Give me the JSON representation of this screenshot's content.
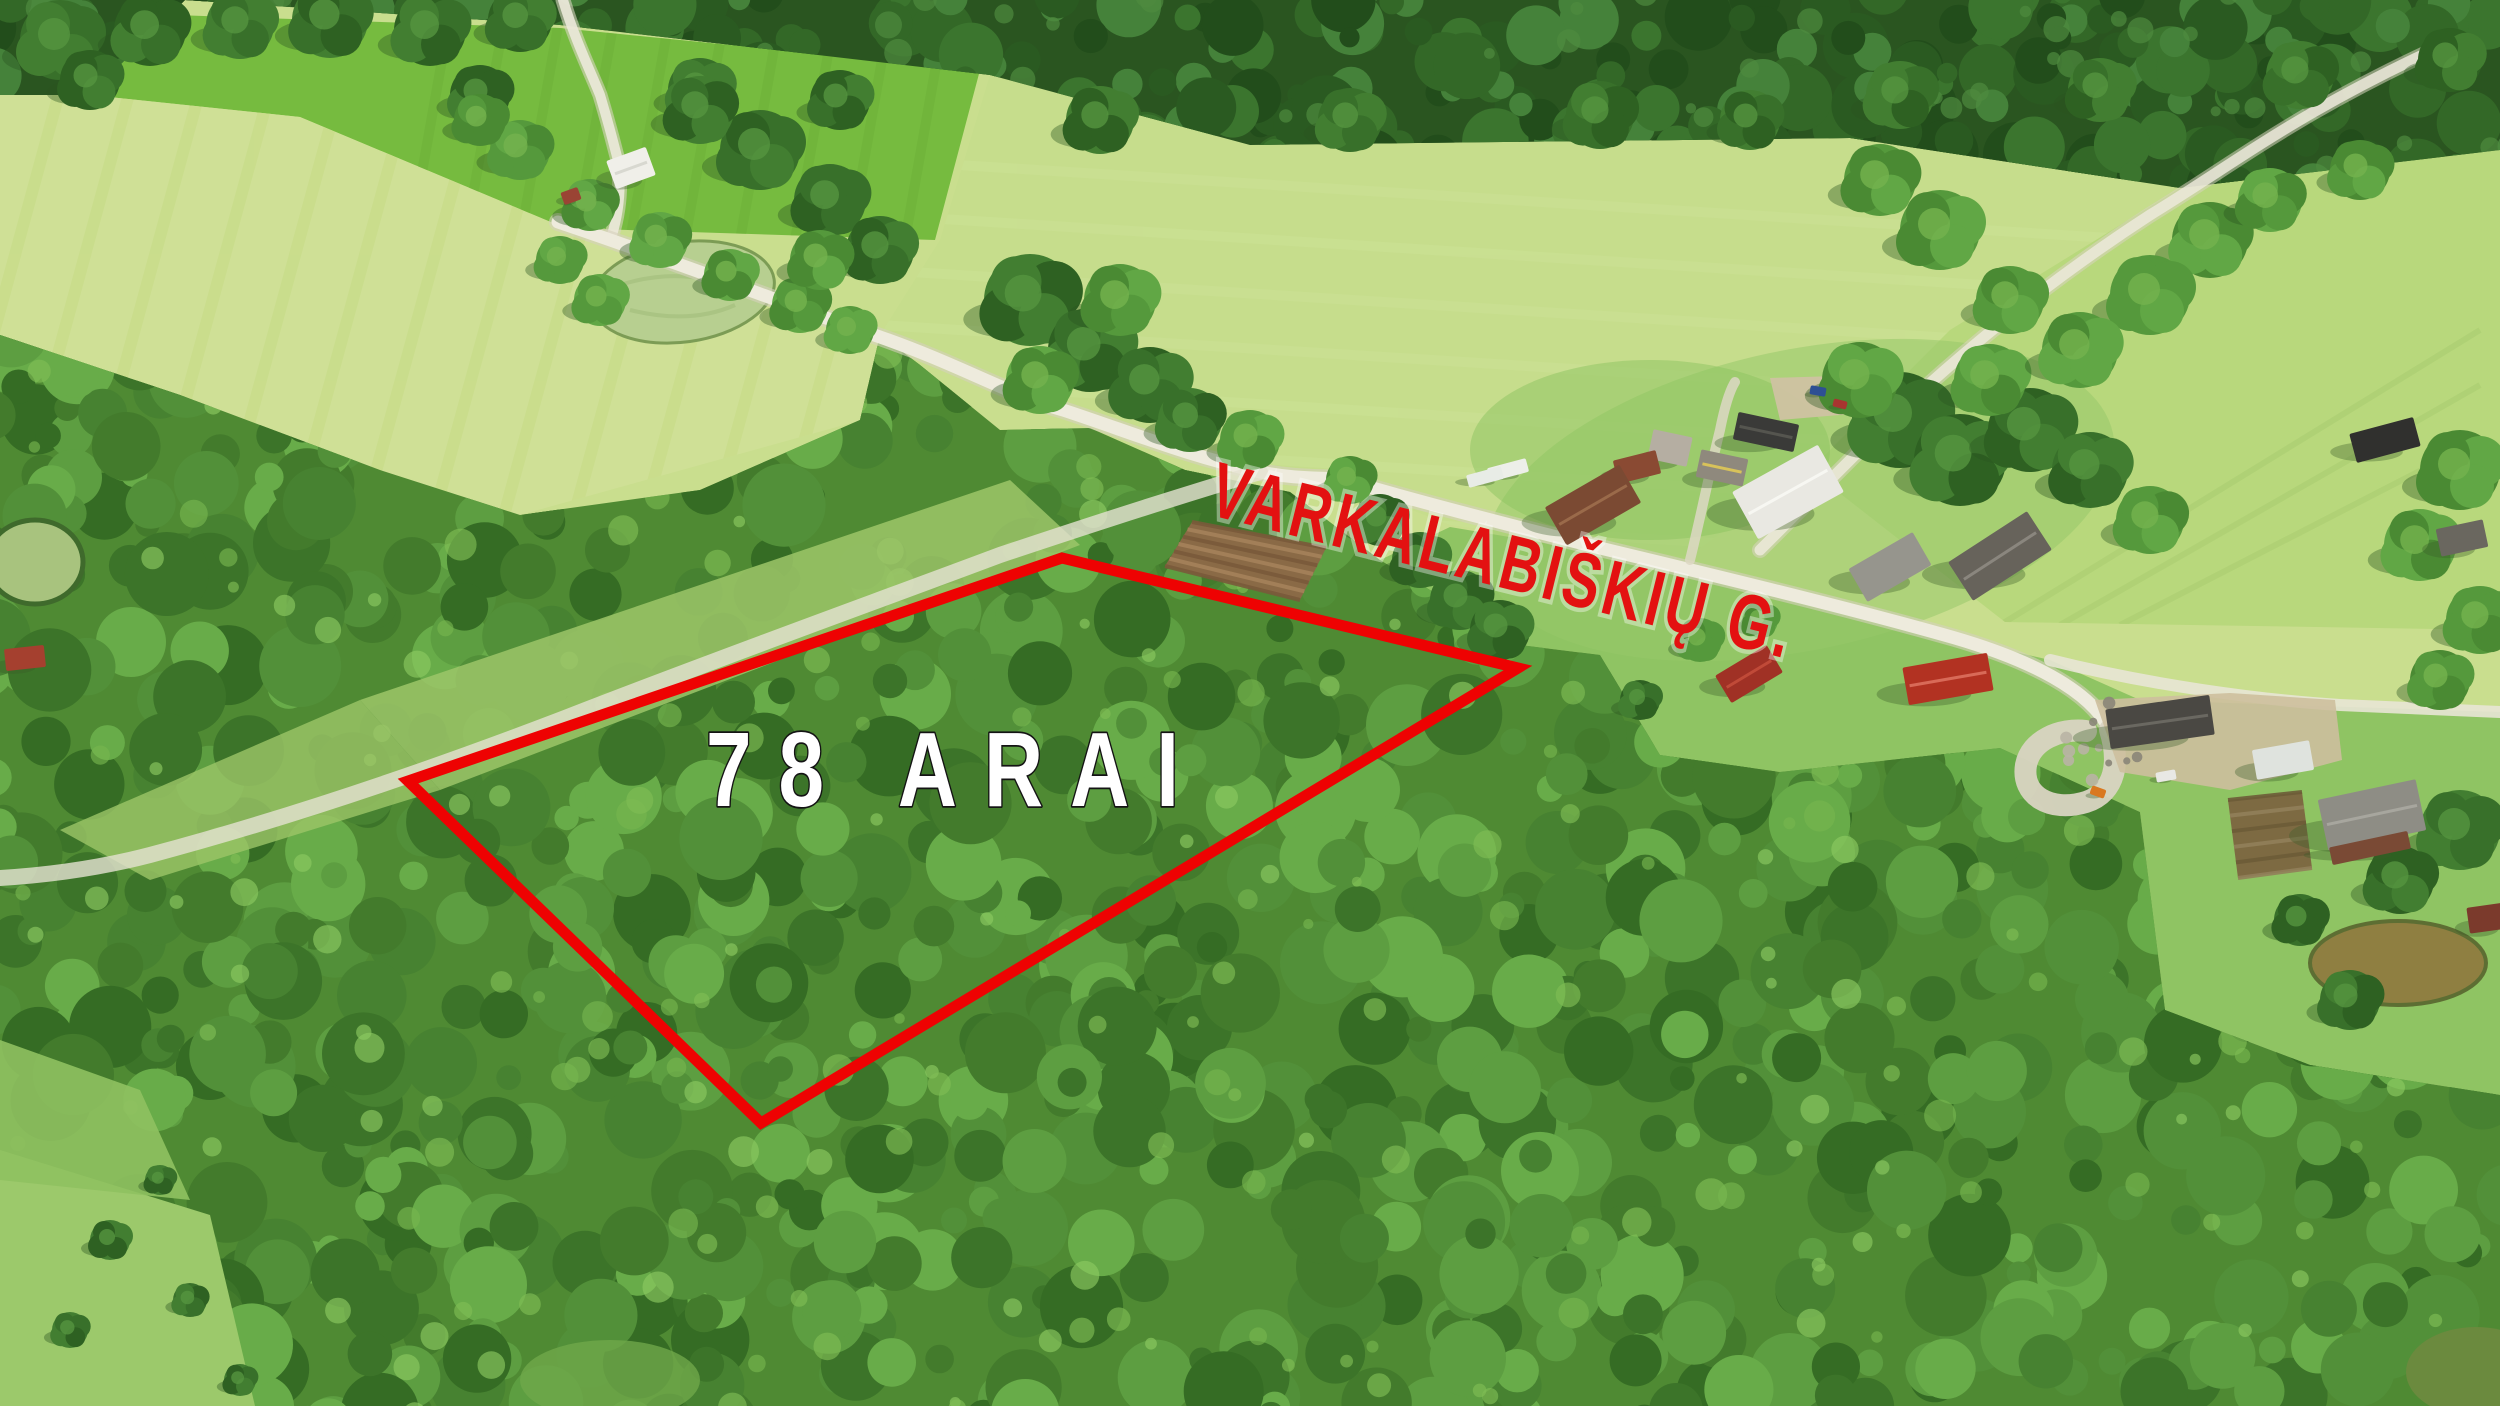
{
  "overlay": {
    "plot_label": {
      "text": "78 ARAI",
      "x": 956,
      "y": 806,
      "color": "#ffffff",
      "outline_color": "#141414"
    },
    "street_label": {
      "text": "VARKALABIŠKIŲ G.",
      "anchor": {
        "x": 1206,
        "y": 514
      },
      "rotation_deg": 14,
      "color": "#e31111"
    },
    "boundary": {
      "points": "1062,558 1518,668 761,1123 408,781",
      "color": "#ee0202",
      "stroke_width": 11
    }
  }
}
